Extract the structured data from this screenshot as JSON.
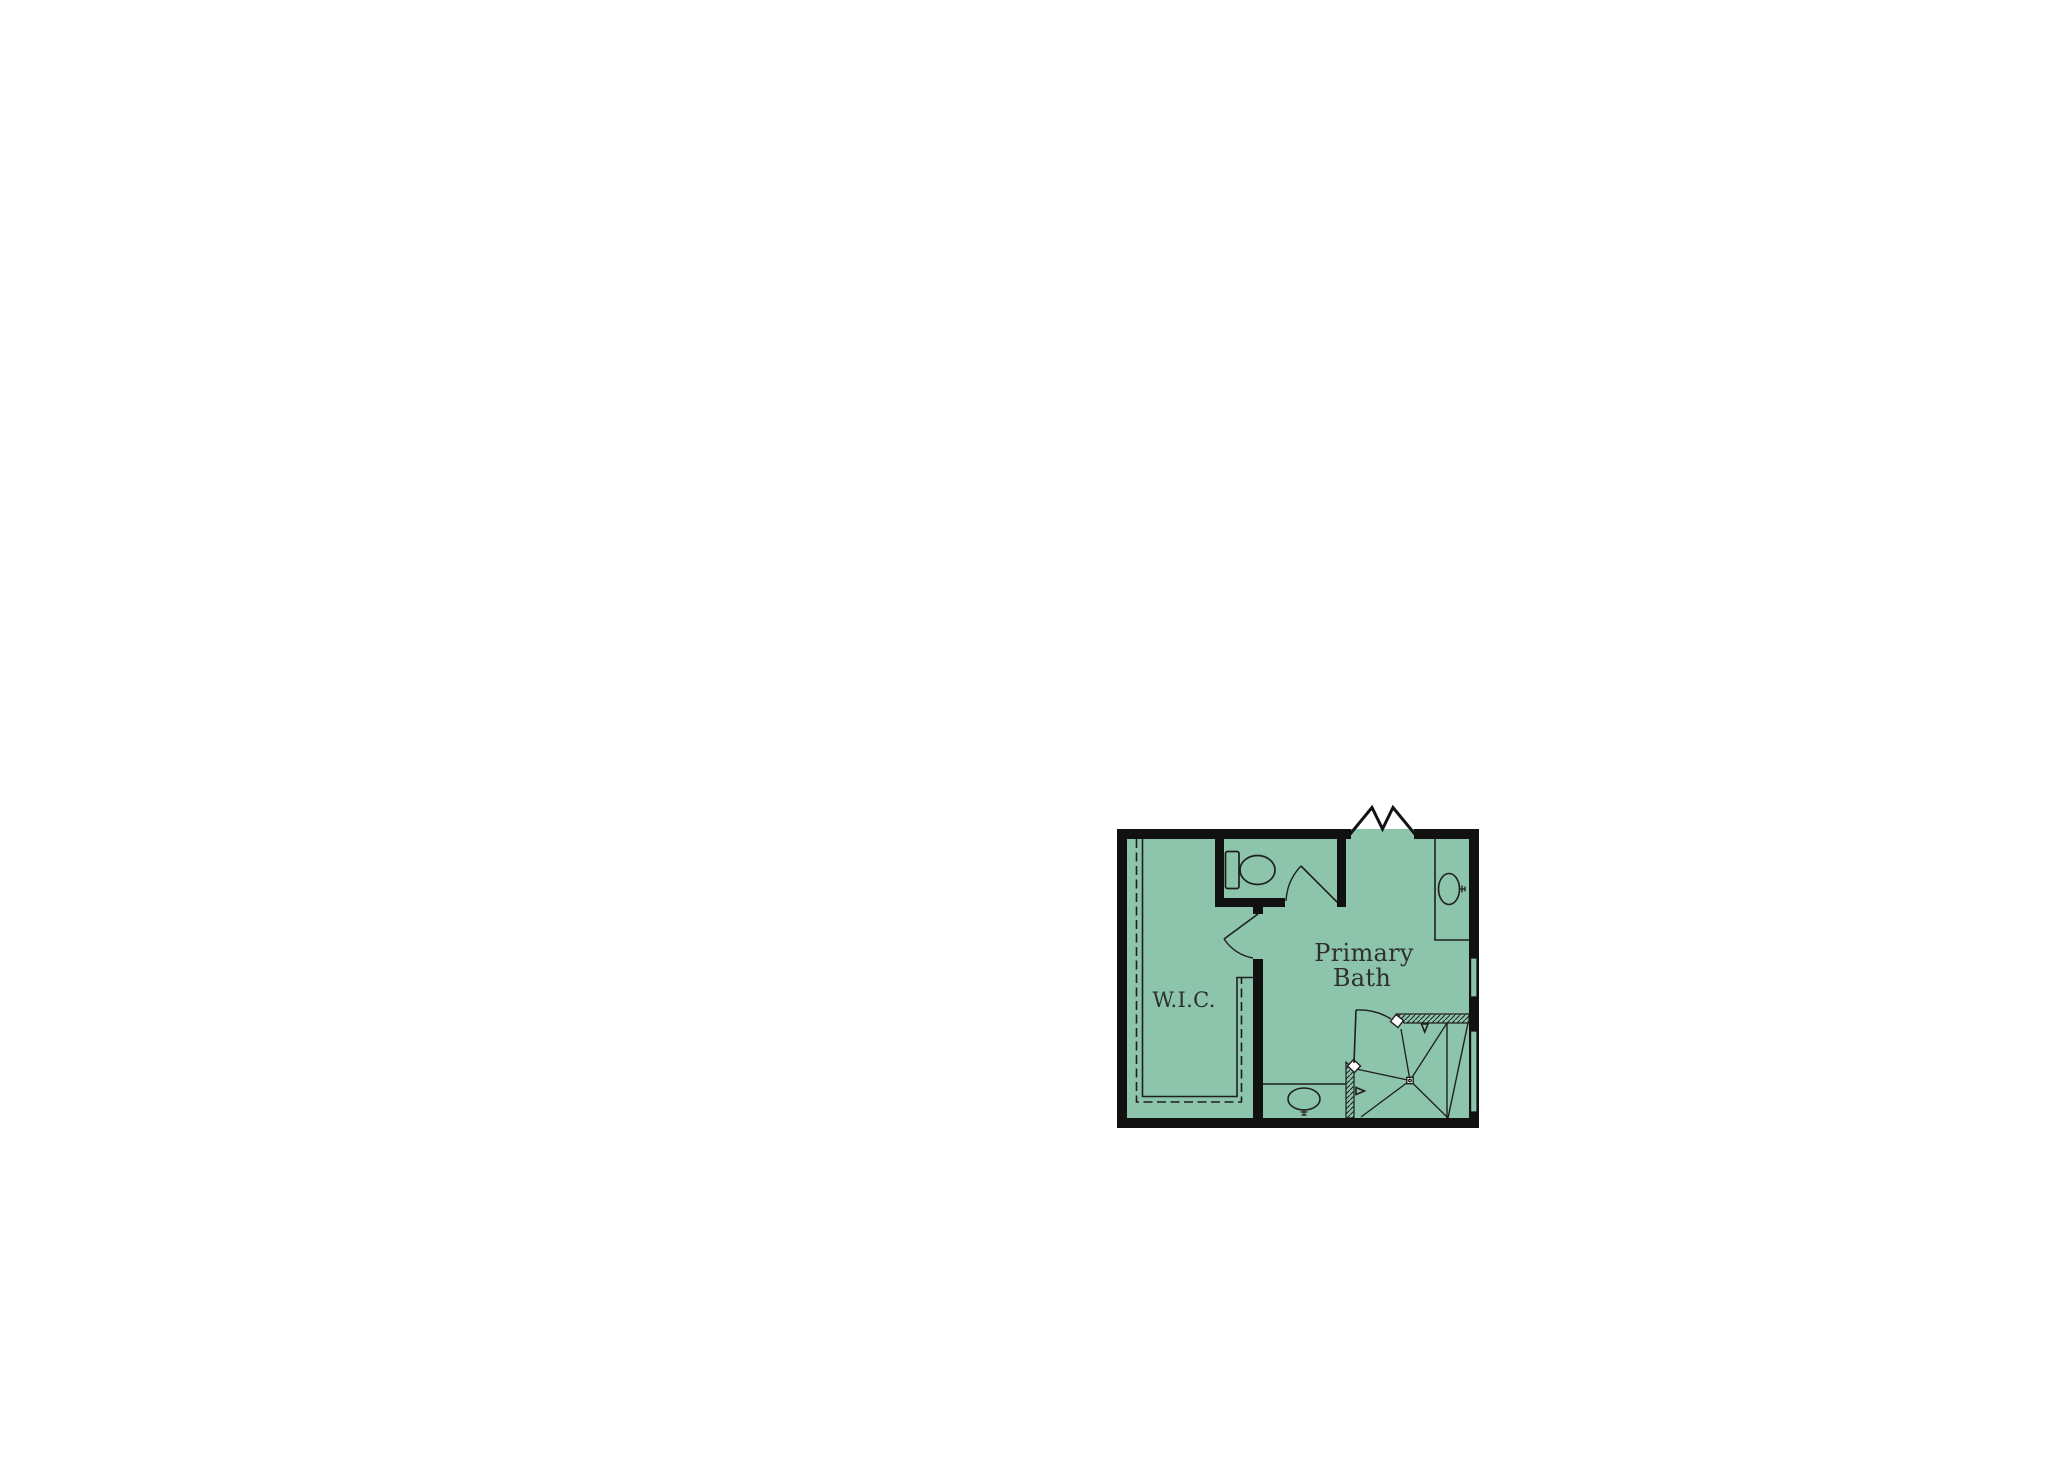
{
  "floor_plan": {
    "rooms": [
      {
        "label": "Primary Bath",
        "label_lines": [
          "Primary",
          "Bath"
        ]
      },
      {
        "label": "W.I.C."
      }
    ],
    "fixtures": [
      "toilet",
      "vanity-sink-top-right",
      "vanity-sink-bottom",
      "corner-shower-with-drain",
      "closet-rod-and-shelf",
      "entry-opening",
      "toilet-room-door",
      "closet-door",
      "shower-door",
      "window-right-upper",
      "window-right-lower"
    ],
    "colors": {
      "floor_fill": "#8CC4AC",
      "walls": "#111111",
      "lines": "#1F1F1F",
      "label_text": "#2F2F2F",
      "page_background": "#FFFFFF"
    }
  }
}
